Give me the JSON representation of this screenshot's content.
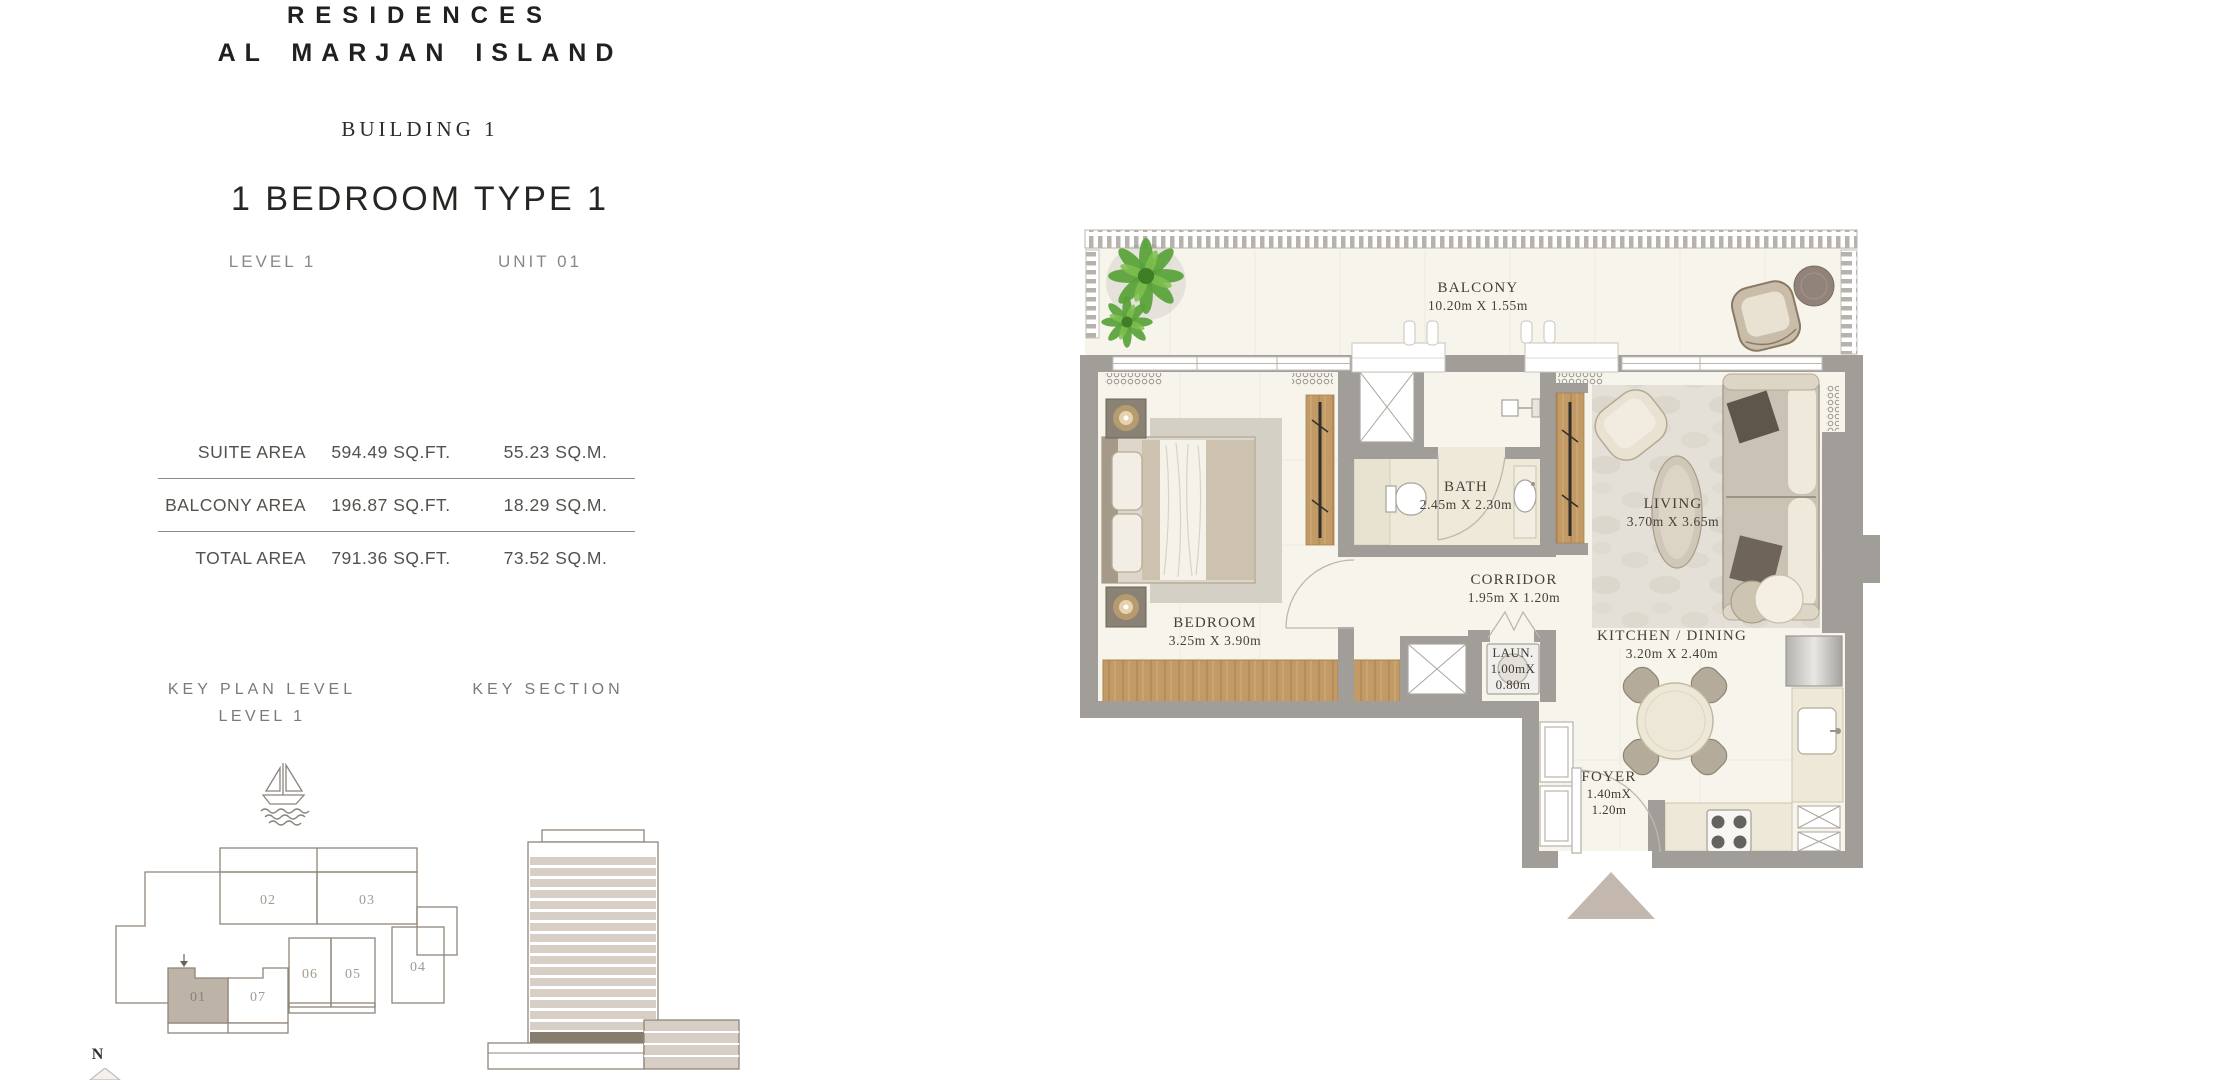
{
  "header": {
    "brand_line1": "RESIDENCES",
    "brand_line2": "AL MARJAN ISLAND",
    "building": "BUILDING 1",
    "unit_type": "1 BEDROOM TYPE 1",
    "level": "LEVEL 1",
    "unit": "UNIT 01"
  },
  "area_table": {
    "rows": [
      {
        "label": "SUITE AREA",
        "imperial": "594.49 SQ.FT.",
        "metric": "55.23 SQ.M."
      },
      {
        "label": "BALCONY AREA",
        "imperial": "196.87 SQ.FT.",
        "metric": "18.29 SQ.M."
      },
      {
        "label": "TOTAL AREA",
        "imperial": "791.36 SQ.FT.",
        "metric": "73.52 SQ.M."
      }
    ]
  },
  "key_plan": {
    "title": "KEY PLAN LEVEL",
    "subtitle": "LEVEL 1",
    "north": "N",
    "highlighted_unit": "01",
    "units": {
      "u01": "01",
      "u02": "02",
      "u03": "03",
      "u04": "04",
      "u05": "05",
      "u06": "06",
      "u07": "07"
    }
  },
  "key_section": {
    "title": "KEY SECTION"
  },
  "floor_plan": {
    "balcony": {
      "name": "BALCONY",
      "dims": "10.20m X 1.55m"
    },
    "bath": {
      "name": "BATH",
      "dims": "2.45m X 2.30m"
    },
    "living": {
      "name": "LIVING",
      "dims": "3.70m X 3.65m"
    },
    "corridor": {
      "name": "CORRIDOR",
      "dims": "1.95m X 1.20m"
    },
    "bedroom": {
      "name": "BEDROOM",
      "dims": "3.25m X 3.90m"
    },
    "kitchen": {
      "name": "KITCHEN / DINING",
      "dims": "3.20m X 2.40m"
    },
    "laundry": {
      "name": "LAUN.",
      "dims_l1": "1.00mX",
      "dims_l2": "0.80m"
    },
    "foyer": {
      "name": "FOYER",
      "dims_l1": "1.40mX",
      "dims_l2": "1.20m"
    }
  },
  "colors": {
    "wall_gray": "#a19e9a",
    "floor_cream": "#f7f4ec",
    "wood": "#c29a66",
    "unit_highlight": "#beb3a7",
    "plant_green": "#58a238",
    "entry_marker": "#c3b7ae",
    "section_stripe": "#d7cfc6",
    "section_level": "#867d6c"
  }
}
